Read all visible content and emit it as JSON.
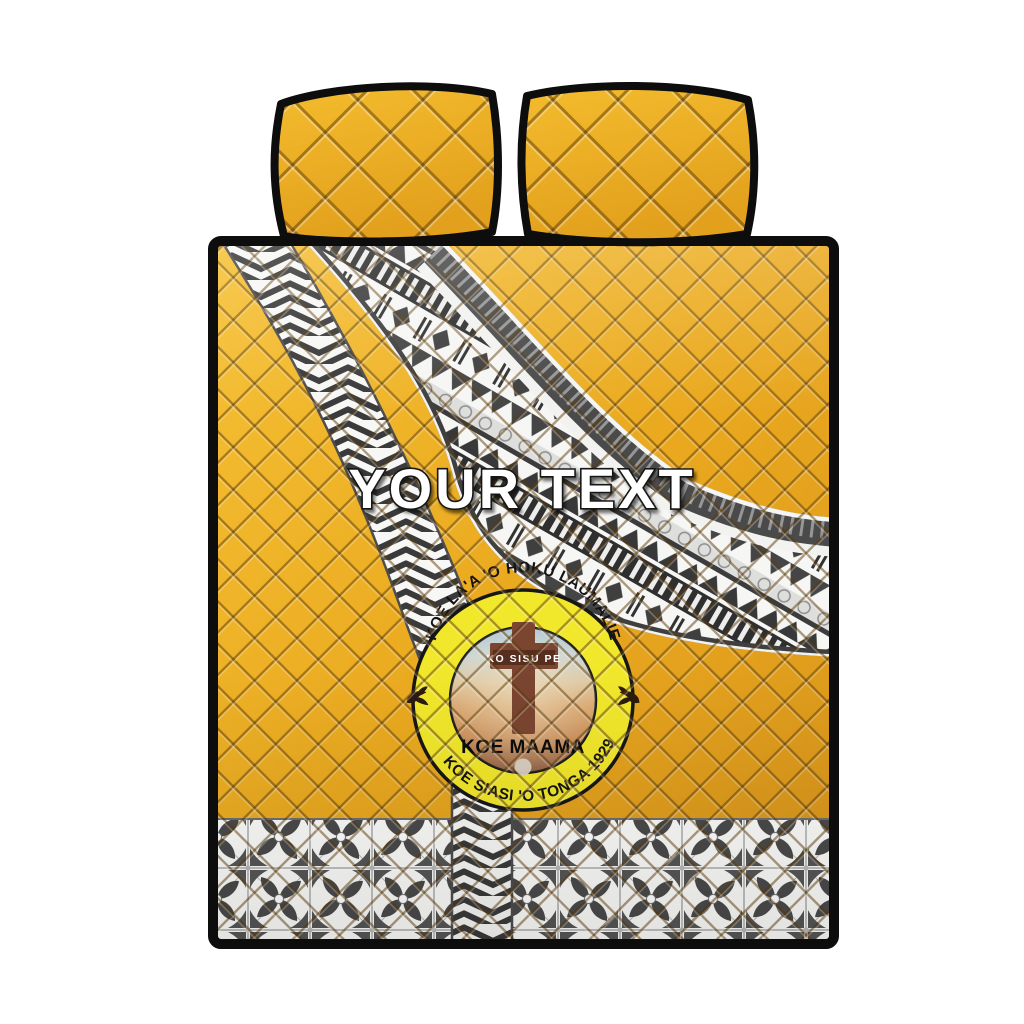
{
  "canvas": {
    "background": "#FFFFFF"
  },
  "bedding_set": {
    "pillow_count": 2,
    "base_color": "#E9A81F",
    "base_color_light": "#F6C135",
    "base_color_deep": "#D8941B",
    "piping_color": "#0D0D0D",
    "pattern_dark": "#3C3C3C",
    "pattern_light": "#F7F7F5"
  },
  "custom_text": {
    "value": "YOUR TEXT",
    "fill": "#FFFFFF",
    "outline": "#161616"
  },
  "seal": {
    "arc_top": "KOE LA'A 'O HOKU LAUMALIE",
    "arc_bottom": "KOE SIASI 'O TONGA 1929",
    "cross_label": "KO SISU PE",
    "caption": "KOE MAAMA",
    "ring_color": "#F1E72B",
    "ring_text_color": "#141414",
    "cross_color": "#7B4530",
    "dove_color": "#2C1A0D"
  }
}
